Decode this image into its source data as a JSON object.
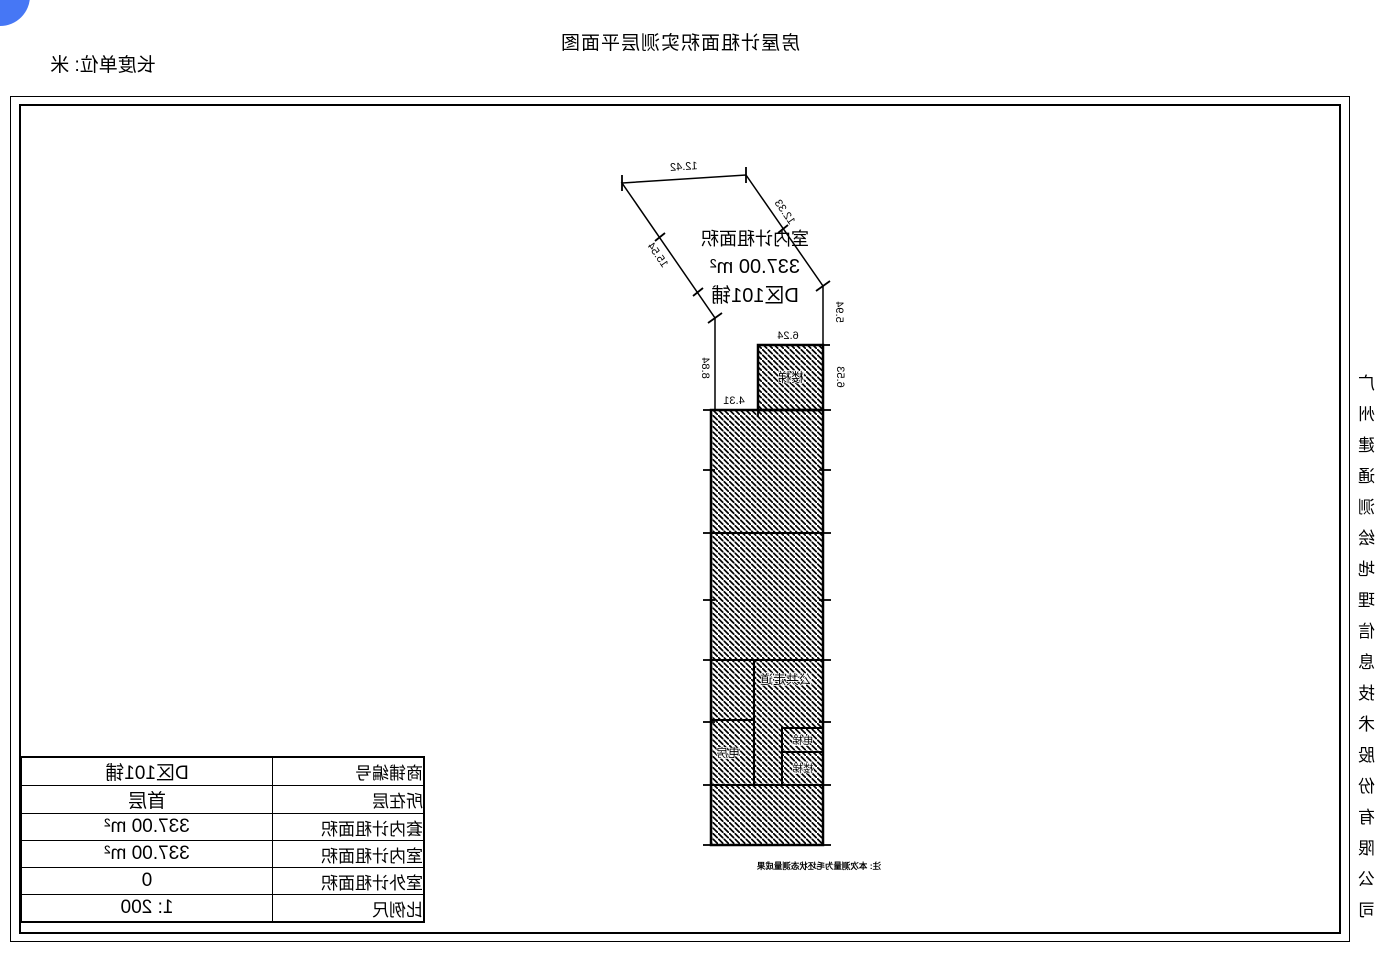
{
  "colors": {
    "accent_blue": "#4677f5",
    "ink": "#000000"
  },
  "header": {
    "title": "房屋计租面积实测层平面图",
    "unit_label": "长度单位: 米"
  },
  "side": {
    "company": "广州建通测绘地理信息技术股份有限公司"
  },
  "plan": {
    "area_label": {
      "line1": "室内计租面积",
      "line2": "337.00 m²",
      "line3": "D区101铺"
    },
    "rooms": {
      "stairs_top": "楼梯",
      "corridor": "公共走道",
      "elevator": "电梯",
      "stairs": "楼梯",
      "electrical": "电房"
    },
    "note": "注: 本次测量为毛坯状态测量成果",
    "dimensions": {
      "top_edge": "12.42",
      "right_slant": "12.33",
      "left_slant": "15.54",
      "right_upper": "5.94",
      "stair_right": "6.53",
      "stair_top": "6.24",
      "left_vertical": "8.84",
      "stair_bottom": "4.31"
    }
  },
  "info_table": {
    "rows": [
      {
        "label": "商铺编号",
        "value": "D区101铺"
      },
      {
        "label": "所在层",
        "value": "首层"
      },
      {
        "label": "套内计租面积",
        "value": "337.00 m²"
      },
      {
        "label": "室内计租面积",
        "value": "337.00 m²"
      },
      {
        "label": "室外计租面积",
        "value": "0"
      },
      {
        "label": "比例尺",
        "value": "1: 200"
      }
    ]
  }
}
